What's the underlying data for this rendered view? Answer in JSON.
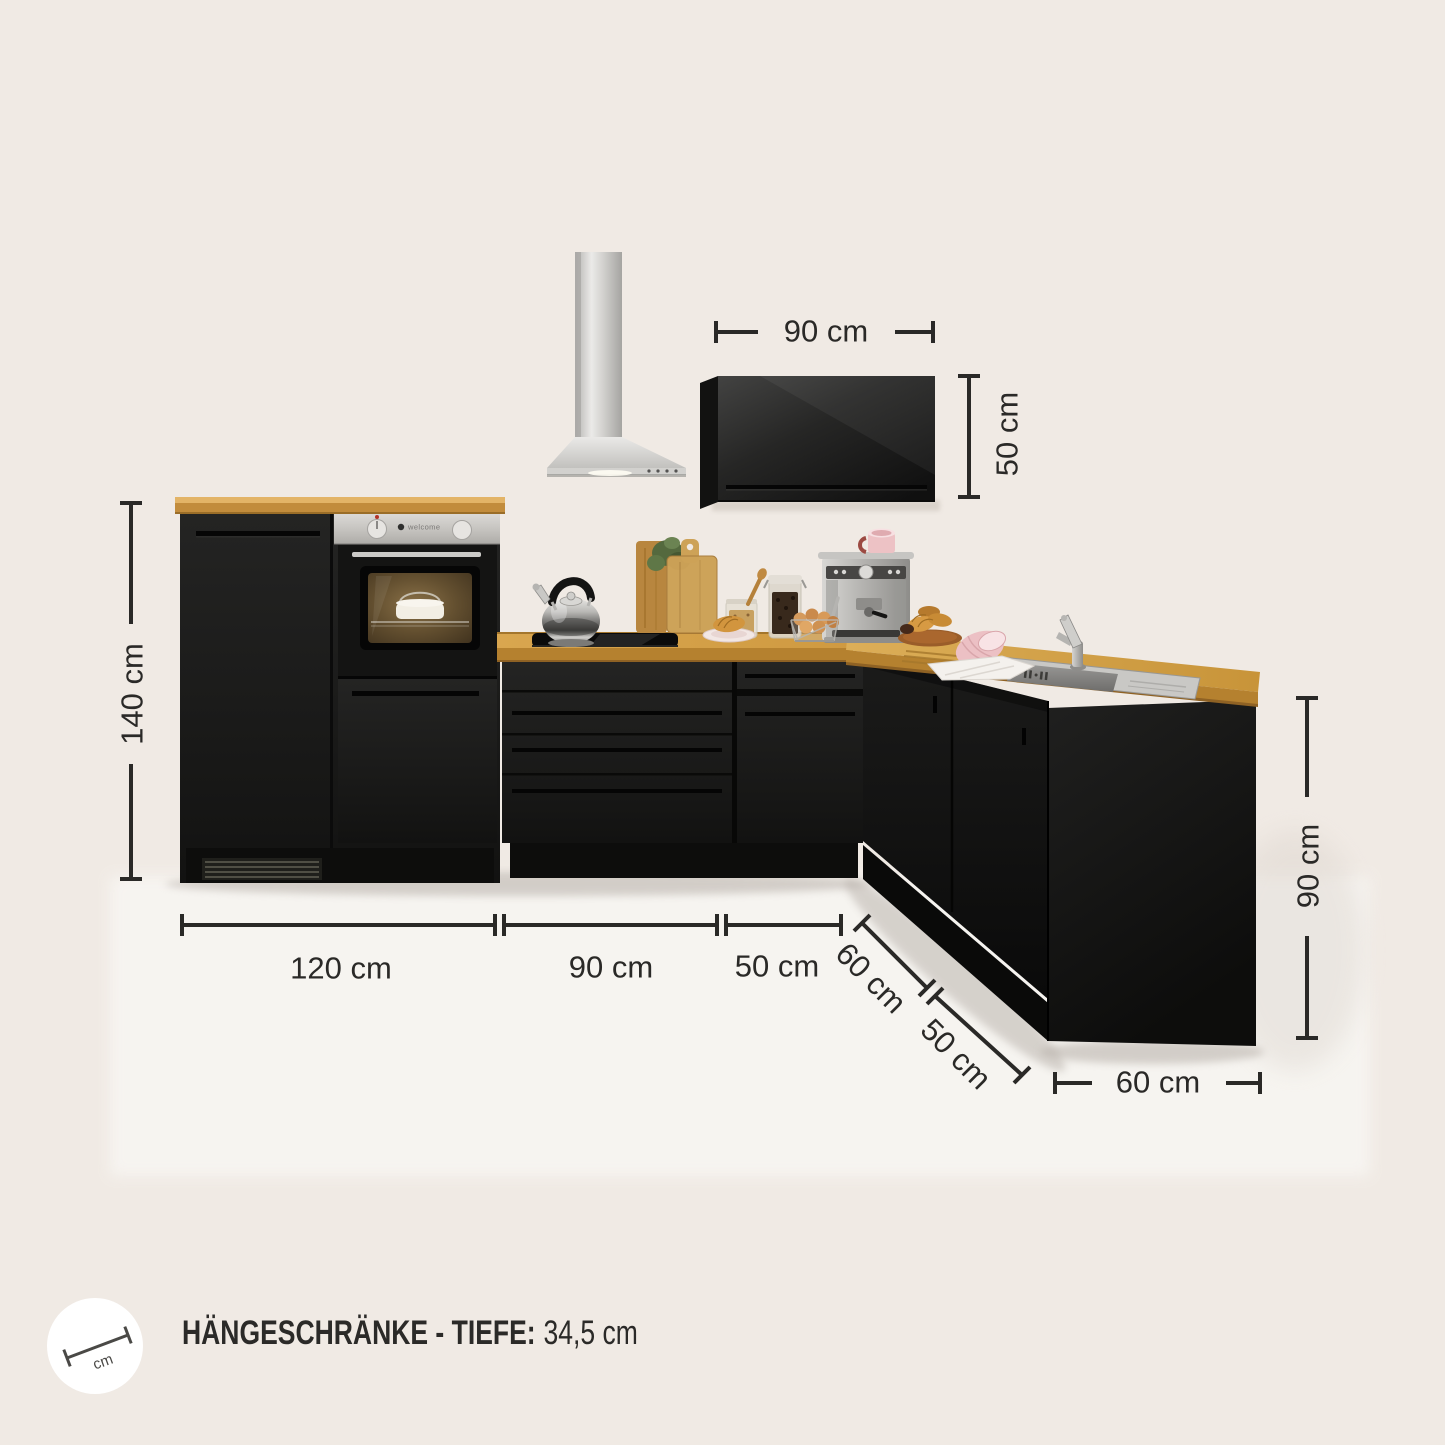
{
  "palette": {
    "background": "#f0eae4",
    "cabinet_black": "#1b1b1a",
    "worktop_oak": "#d8a54d",
    "stainless": "#d6d5d2",
    "dimension_ink": "#2a2927",
    "badge_bg": "#ffffff"
  },
  "dimensions": {
    "wall_cabinet_width": "90 cm",
    "wall_cabinet_height": "50 cm",
    "tall_unit_height": "140 cm",
    "base_run_left": "120 cm",
    "base_run_mid": "90 cm",
    "base_run_right": "50 cm",
    "corner_near": "60 cm",
    "corner_far": "50 cm",
    "return_height": "90 cm",
    "return_width": "60 cm"
  },
  "footer": {
    "icon_text": "cm",
    "label": "HÄNGESCHRÄNKE - TIEFE:",
    "value": "34,5 cm"
  },
  "oven": {
    "brand": "welcome"
  }
}
